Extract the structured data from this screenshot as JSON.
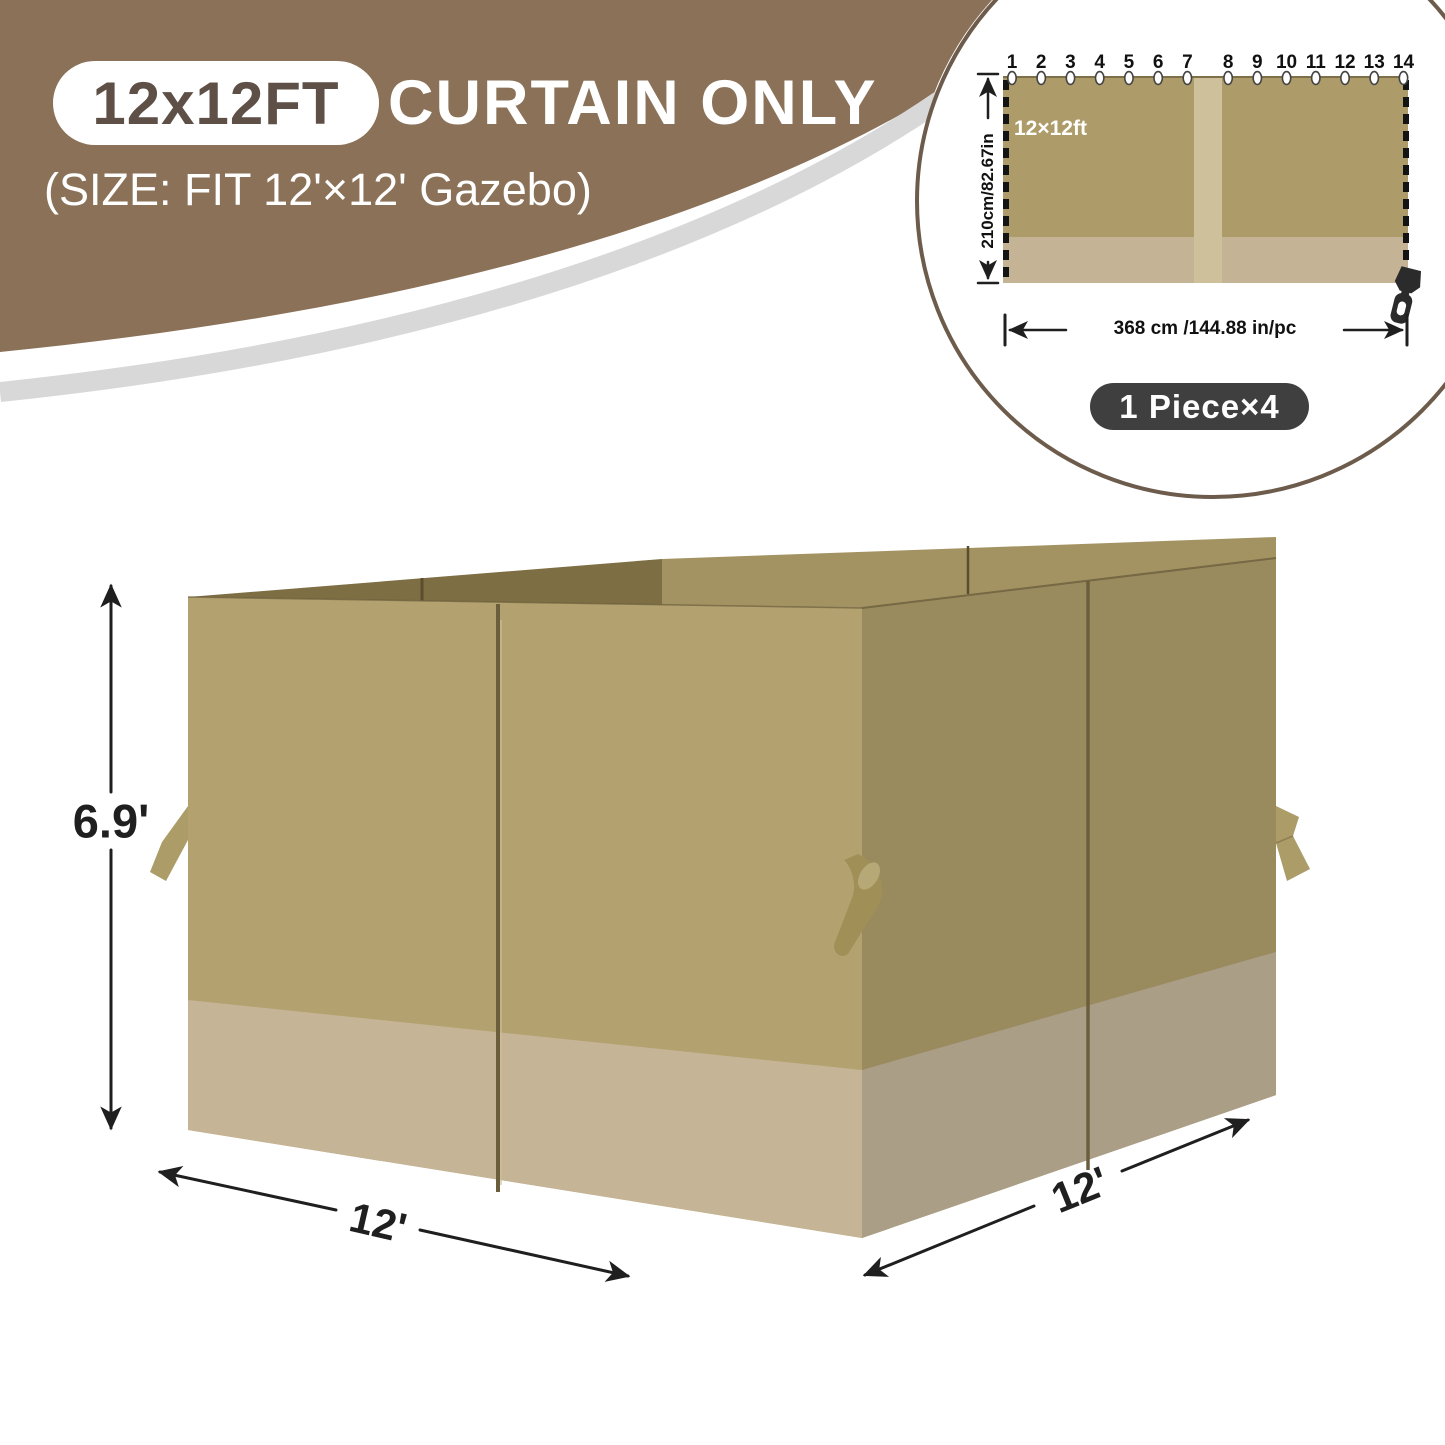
{
  "header": {
    "badge": "12x12FT",
    "title": "CURTAIN ONLY",
    "subtitle": "(SIZE: FIT 12'×12' Gazebo)"
  },
  "inset": {
    "grommet_numbers": [
      "1",
      "2",
      "3",
      "4",
      "5",
      "6",
      "7",
      "8",
      "9",
      "10",
      "11",
      "12",
      "13",
      "14"
    ],
    "panel_label": "12×12ft",
    "height_dim": "210cm/82.67in",
    "width_dim": "368 cm /144.88 in/pc",
    "pieces_badge": "1 Piece×4"
  },
  "gazebo_diagram": {
    "height_dim": "6.9'",
    "front_width_dim": "12'",
    "side_depth_dim": "12'"
  },
  "colors": {
    "c-brown": "#8a7157",
    "c-gray-swoosh": "#d8d8d8",
    "c-badge-text": "#5e5046",
    "c-ring": "#6d5c4c",
    "c-front": "#b3a26f",
    "c-front-band": "#c5b496",
    "c-right": "#9a8b5f",
    "c-right-band": "#ab9e86",
    "c-int-dark": "#7d6e44",
    "c-int-light": "#a49362",
    "c-strap": "#ac9c68",
    "c-strap-dark": "#a09057",
    "c-zip": "#6a5e3d",
    "c-dim": "#1f1f1f",
    "c-curtain": "#ad9c69",
    "c-curtain-band": "#c4b395",
    "c-curtain-stripe": "#cfc09c",
    "c-pill": "#3f3f3f",
    "c-slider": "#2b2b2b"
  }
}
